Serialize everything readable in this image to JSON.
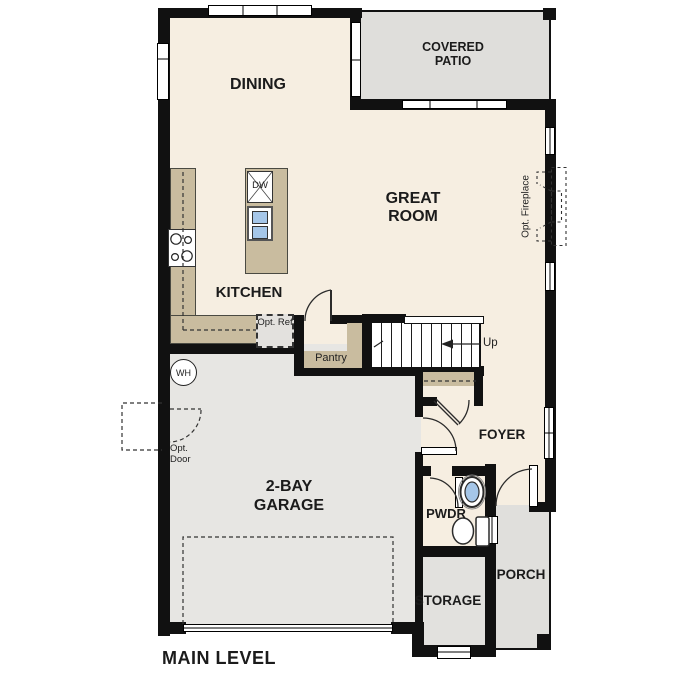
{
  "title": "MAIN LEVEL",
  "rooms": {
    "dining": {
      "label": "DINING"
    },
    "covered_patio": {
      "label": "COVERED PATIO"
    },
    "great_room": {
      "label": "GREAT ROOM"
    },
    "kitchen": {
      "label": "KITCHEN"
    },
    "foyer": {
      "label": "FOYER"
    },
    "garage": {
      "label": "2-BAY GARAGE"
    },
    "pwdr": {
      "label": "PWDR"
    },
    "storage": {
      "label": "STORAGE"
    },
    "porch": {
      "label": "PORCH"
    }
  },
  "annotations": {
    "opt_fireplace": "Opt. Fireplace",
    "opt_ref": "Opt. Ref",
    "opt_door": "Opt. Door",
    "pantry": "Pantry",
    "up": "Up",
    "water_heater": "WH",
    "dishwasher": "DW"
  },
  "colors": {
    "wall": "#111111",
    "floor": "#f6eee1",
    "patio": "#dfdedb",
    "garage": "#e7e6e3",
    "porch": "#e0dfdc",
    "storage": "#e2e1de",
    "counter": "#c9bc9f",
    "fixture_blue": "#a5c6e8"
  }
}
